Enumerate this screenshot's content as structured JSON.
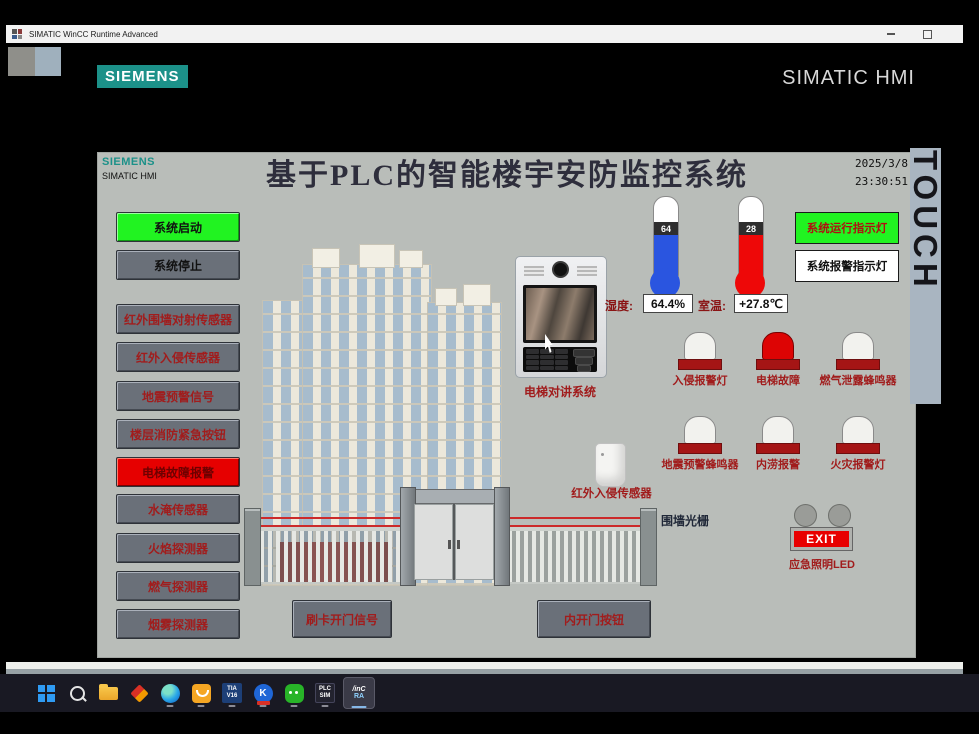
{
  "window": {
    "title": "SIMATIC WinCC Runtime Advanced"
  },
  "header": {
    "siemens": "SIEMENS",
    "simatic": "SIMATIC HMI"
  },
  "hmi": {
    "logo": "SIEMENS",
    "logo_sub": "SIMATIC HMI",
    "title": "基于PLC的智能楼宇安防监控系统",
    "date": "2025/3/8",
    "time": "23:30:51",
    "touch": "TOUCH",
    "left_buttons": [
      {
        "label": "系统启动"
      },
      {
        "label": "系统停止"
      },
      {
        "label": "红外围墙对射传感器"
      },
      {
        "label": "红外入侵传感器"
      },
      {
        "label": "地震预警信号"
      },
      {
        "label": "楼层消防紧急按钮"
      },
      {
        "label": "电梯故障报警"
      },
      {
        "label": "水淹传感器"
      },
      {
        "label": "火焰探测器"
      },
      {
        "label": "燃气探测器"
      },
      {
        "label": "烟雾探测器"
      }
    ],
    "indicators": [
      {
        "label": "系统运行指示灯",
        "state": "on"
      },
      {
        "label": "系统报警指示灯",
        "state": "off"
      }
    ],
    "thermometers": [
      {
        "value": "64",
        "label": "湿度:",
        "reading": "64.4%",
        "color": "blue"
      },
      {
        "value": "28",
        "label": "室温:",
        "reading": "+27.8℃",
        "color": "red"
      }
    ],
    "alarms": [
      {
        "label": "入侵报警灯",
        "lit": false
      },
      {
        "label": "电梯故障",
        "lit": true
      },
      {
        "label": "燃气泄露蜂鸣器",
        "lit": false
      },
      {
        "label": "地震预警蜂鸣器",
        "lit": false
      },
      {
        "label": "内涝报警",
        "lit": false
      },
      {
        "label": "火灾报警灯",
        "lit": false
      }
    ],
    "labels": {
      "intercom": "电梯对讲系统",
      "pir": "红外入侵传感器",
      "fence": "围墙光栅",
      "exit": "EXIT",
      "exit_led": "应急照明LED"
    },
    "bottom_buttons": [
      {
        "label": "刷卡开门信号"
      },
      {
        "label": "内开门按钮"
      }
    ]
  },
  "taskbar": {
    "k_letter": "K",
    "tia_top": "TIA",
    "tia_bottom": "V16",
    "plc_top": "PLC",
    "plc_bottom": "SIM",
    "wincc_top": "/inC",
    "wincc_bottom": "RA"
  },
  "colors": {
    "siemens_teal": "#1c9189",
    "accent_green": "#21f321",
    "alarm_red": "#e60000",
    "screen_bg": "#b9bdb9",
    "beam_red": "#cc2a2a"
  }
}
